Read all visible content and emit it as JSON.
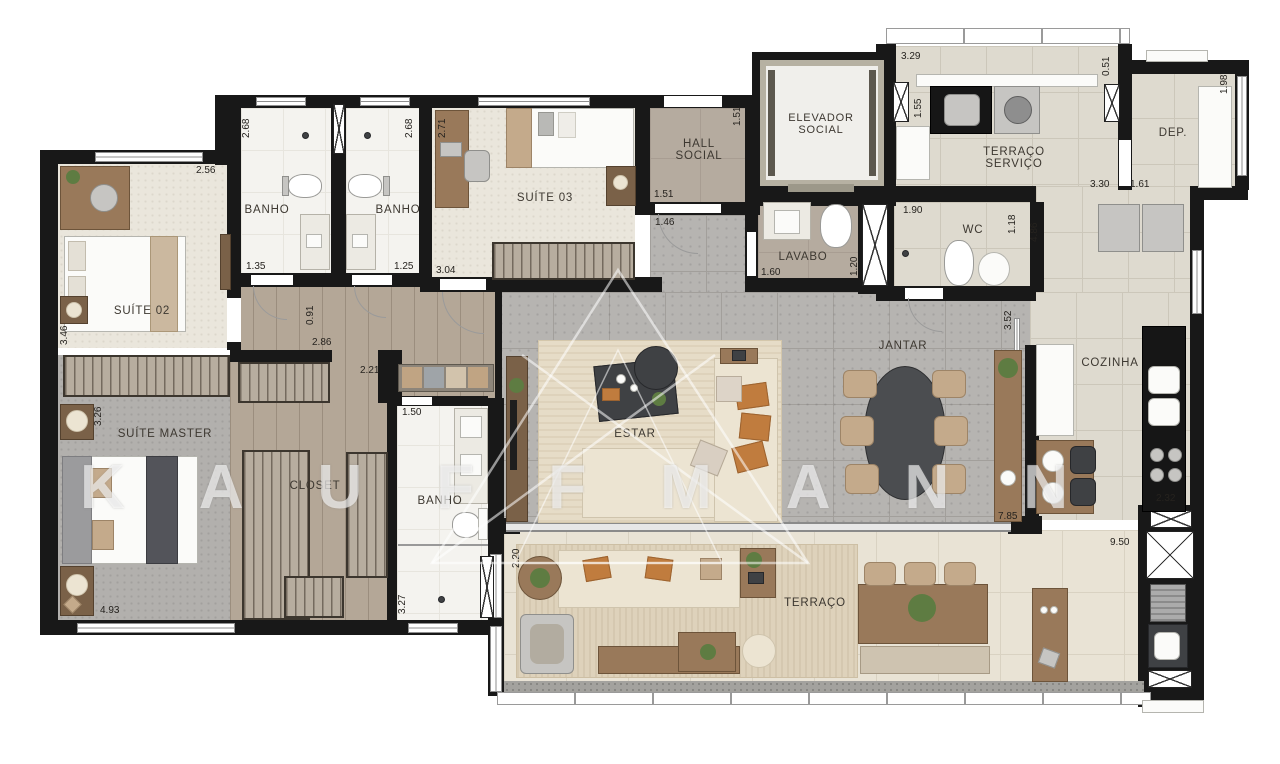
{
  "watermark": "KAUFFMANN",
  "rooms": {
    "suite02": "SUÍTE 02",
    "banho1": "BANHO",
    "banho2": "BANHO",
    "suite03": "SUÍTE 03",
    "hall": {
      "l1": "HALL",
      "l2": "SOCIAL"
    },
    "elevador": {
      "l1": "ELEVADOR",
      "l2": "SOCIAL"
    },
    "terraco_servico": {
      "l1": "TERRAÇO",
      "l2": "SERVIÇO"
    },
    "dep": "DEP.",
    "lavabo": "LAVABO",
    "wc": "WC",
    "suite_master": "SUÍTE MASTER",
    "closet": "CLOSET",
    "banho_master": "BANHO",
    "estar": "ESTAR",
    "jantar": "JANTAR",
    "cozinha": "COZINHA",
    "terraco": "TERRAÇO"
  },
  "dims": {
    "s02_top": "2.56",
    "s02_left": "3.46",
    "b1_h": "2.68",
    "b1_w": "1.35",
    "b2_h": "2.68",
    "b2_w": "1.25",
    "s03_left": "2.71",
    "s03_w": "3.04",
    "corr_a": "0.91",
    "corr_b": "2.86",
    "corr_c": "2.21",
    "bm_w": "1.50",
    "bm_h": "3.27",
    "hall_v": "1.51",
    "hall_h": "1.51",
    "hall_h2": "1.46",
    "lav_w": "1.60",
    "lav_h": "1.20",
    "ts_w": "3.29",
    "ts_r": "0.51",
    "ts_l": "1.55",
    "ts_b1": "3.30",
    "ts_b2": "1.61",
    "dep_h": "1.98",
    "wc_w": "1.90",
    "wc_h": "1.18",
    "corr_d": "4.86",
    "jan_v": "3.52",
    "jan_w": "7.85",
    "coz_c": "2.32",
    "coz_w": "9.50",
    "terr_v": "2.20",
    "sm_l": "3.26",
    "sm_w": "4.93"
  },
  "colors": {
    "wall": "#181818",
    "social_floor": "#b6b4b1",
    "wood_floor": "#b4a797",
    "service_floor": "#dedacf"
  }
}
